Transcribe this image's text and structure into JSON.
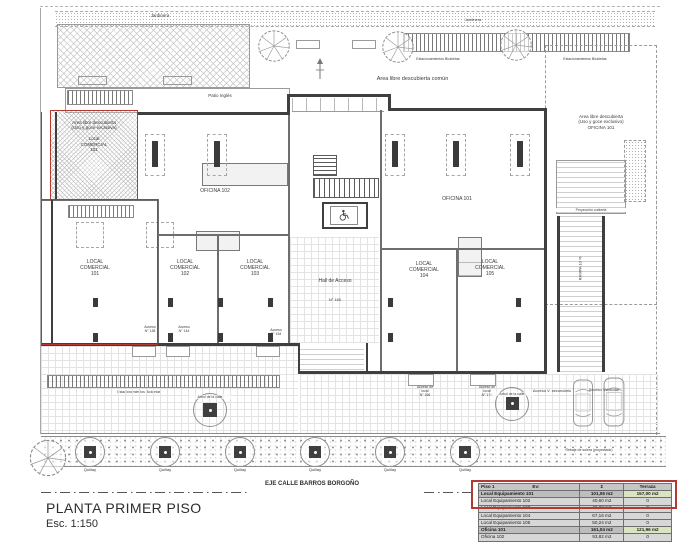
{
  "title": {
    "main": "PLANTA PRIMER PISO",
    "scale": "Esc. 1:150"
  },
  "street": {
    "axis": "EJE CALLE BARROS BORGOÑO",
    "solera_note": "Rebaje de solera (proyectado)"
  },
  "colors": {
    "highlight_red": "#b23a32",
    "table_green": "#d9e5c0",
    "wall": "#3f3f3f"
  },
  "plan": {
    "jardinera": "Jardinera",
    "patio_ingles": "Patio Inglés",
    "area_comun": "Area libre descubierta común",
    "bicicletas": "Estacionamientos Bicicletas",
    "terraza_local": {
      "l1": "Area libre descubierta",
      "l2": "(Uso y goce exclusivo)",
      "l3": "Local",
      "l4": "COMERCIAL",
      "l5": "101"
    },
    "terraza_oficina": {
      "l1": "Area libre descubierta",
      "l2": "(Uso y goce exclusivo)",
      "l3": "OFICINA 101"
    },
    "oficina_102": "OFICINA 102",
    "oficina_101": "OFICINA 101",
    "rooms": [
      {
        "l1": "LOCAL",
        "l2": "COMERCIAL",
        "l3": "101"
      },
      {
        "l1": "LOCAL",
        "l2": "COMERCIAL",
        "l3": "102"
      },
      {
        "l1": "LOCAL",
        "l2": "COMERCIAL",
        "l3": "103"
      },
      {
        "l1": "LOCAL",
        "l2": "COMERCIAL",
        "l3": "104"
      },
      {
        "l1": "LOCAL",
        "l2": "COMERCIAL",
        "l3": "105"
      }
    ],
    "hall": {
      "l1": "Hall de Acceso",
      "l2": "N° 160"
    },
    "accesos": {
      "a138": {
        "l1": "Acceso",
        "l2": "N° 138"
      },
      "a144": {
        "l1": "Acceso",
        "l2": "N° 144"
      },
      "a154": {
        "l1": "Acceso",
        "l2": "N° 154"
      },
      "a166": {
        "l1": "Acceso de",
        "l2": "local",
        "l3": "N° 166"
      },
      "a176": {
        "l1": "Acceso de",
        "l2": "local",
        "l3": "N° 176"
      },
      "secundario": "Acceso V. secundario",
      "vehicular": "Acceso Vehicular"
    },
    "rampa": "RAMPA 10 %",
    "proyeccion": "Proyección cubierta",
    "arbol_calle": "Arbol de la calle",
    "quillay": "Quillay"
  },
  "table": {
    "header": {
      "piso": "Piso 1",
      "ev": "Ev:",
      "sum": "Σ",
      "terraza": "Terraza"
    },
    "rows": [
      {
        "name": "Local Equipamiento 101",
        "area": "101,06 m2",
        "terraza": "157,00 m2"
      },
      {
        "name": "Local Equipamiento 102",
        "area": "40,60 m2",
        "terraza": "0"
      },
      {
        "name": "Local Equipamiento 103",
        "area": "46,22 m2",
        "terraza": "0"
      },
      {
        "name": "Local Equipamiento 104",
        "area": "67,16 m2",
        "terraza": "0"
      },
      {
        "name": "Local Equipamiento 105",
        "area": "50,24 m2",
        "terraza": "0"
      },
      {
        "name": "Oficina 101",
        "area": "161,04 m2",
        "terraza": "121,96 m2"
      },
      {
        "name": "Oficina 102",
        "area": "93,82 m2",
        "terraza": "0"
      }
    ]
  }
}
